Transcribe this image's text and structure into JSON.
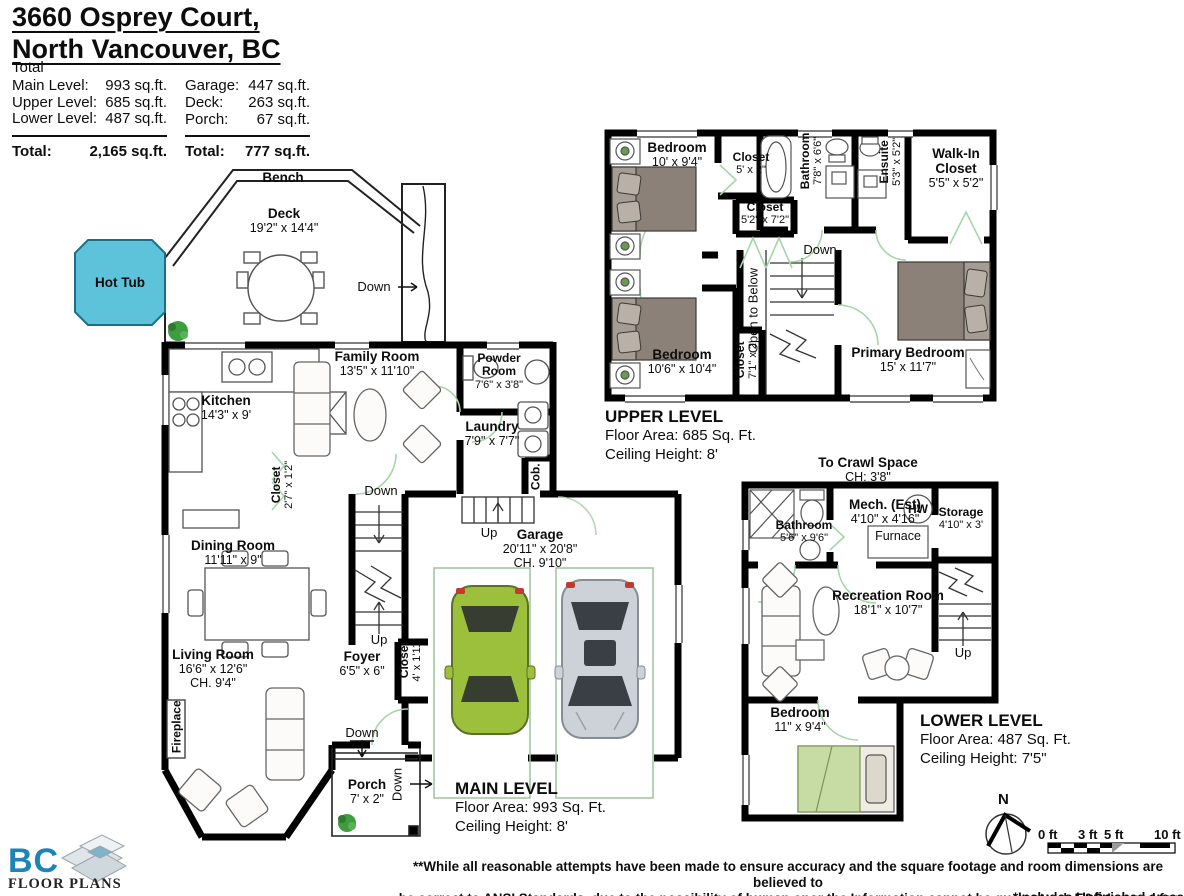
{
  "title": {
    "line1": "3660 Osprey Court,",
    "line2": "North Vancouver, BC"
  },
  "areas": {
    "header": "Total",
    "rows_left": [
      {
        "label": "Main Level:",
        "value": "993 sq.ft."
      },
      {
        "label": "Upper Level:",
        "value": "685 sq.ft."
      },
      {
        "label": "Lower Level:",
        "value": "487 sq.ft."
      }
    ],
    "total_left": {
      "label": "Total:",
      "value": "2,165 sq.ft."
    },
    "rows_right": [
      {
        "label": "Garage:",
        "value": "447 sq.ft."
      },
      {
        "label": "Deck:",
        "value": "263 sq.ft."
      },
      {
        "label": "Porch:",
        "value": "67 sq.ft."
      }
    ],
    "total_right": {
      "label": "Total:",
      "value": "777 sq.ft."
    }
  },
  "labels": {
    "down": "Down",
    "up": "Up",
    "bench": "Bench",
    "hot_tub": "Hot Tub",
    "open_to_below": "Open to Below",
    "north": "N"
  },
  "main_level": {
    "heading": "MAIN LEVEL",
    "floor_area": "Floor Area: 993 Sq. Ft.",
    "ceiling": "Ceiling Height: 8'",
    "rooms": {
      "deck": {
        "name": "Deck",
        "dims": "19'2\" x 14'4\""
      },
      "kitchen": {
        "name": "Kitchen",
        "dims": "14'3\" x 9'"
      },
      "family_room": {
        "name": "Family Room",
        "dims": "13'5\" x 11'10\""
      },
      "powder_room": {
        "name1": "Powder",
        "name2": "Room",
        "dims": "7'6\" x 3'8\""
      },
      "laundry": {
        "name": "Laundry",
        "dims": "7'9\" x 7'7\""
      },
      "cab": "Cob.",
      "closet_hall": {
        "name": "Closet",
        "dims": "2'7\" x 1'2\""
      },
      "dining_room": {
        "name": "Dining Room",
        "dims": "11'11\" x 9\""
      },
      "living_room": {
        "name": "Living Room",
        "dims": "16'6\" x 12'6\"",
        "ch": "CH. 9'4\""
      },
      "fireplace": "Fireplace",
      "foyer": {
        "name": "Foyer",
        "dims": "6'5\" x 6\""
      },
      "closet_foyer": {
        "name": "Closet",
        "dims": "4' x 1'11\""
      },
      "garage": {
        "name": "Garage",
        "dims": "20'11\" x 20'8\"",
        "ch": "CH. 9'10\""
      },
      "porch": {
        "name": "Porch",
        "dims": "7' x 2\""
      }
    }
  },
  "upper_level": {
    "heading": "UPPER LEVEL",
    "floor_area": "Floor Area: 685 Sq. Ft.",
    "ceiling": "Ceiling Height: 8'",
    "rooms": {
      "bedroom1": {
        "name": "Bedroom",
        "dims": "10' x 9'4\""
      },
      "closet1": {
        "name": "Closet",
        "dims": "5' x 2\""
      },
      "bathroom": {
        "name": "Bathroom",
        "dims": "7'8\" x 6'6\""
      },
      "ensuite": {
        "name": "Ensuite",
        "dims": "5'3\" x 5'2\""
      },
      "walk_in_closet": {
        "name1": "Walk-In",
        "name2": "Closet",
        "dims": "5'5\" x 5'2\""
      },
      "closet2": {
        "name": "Closet",
        "dims": "5'2\" x 7'2\""
      },
      "closet3": {
        "name": "Closet",
        "dims": "7'1\" x 2'"
      },
      "bedroom2": {
        "name": "Bedroom",
        "dims": "10'6\" x 10'4\""
      },
      "primary": {
        "name": "Primary Bedroom",
        "dims": "15' x 11'7\""
      }
    }
  },
  "lower_level": {
    "heading": "LOWER LEVEL",
    "floor_area": "Floor Area: 487 Sq. Ft.",
    "ceiling": "Ceiling Height: 7'5\"",
    "crawl": {
      "name": "To Crawl Space",
      "dims": "CH: 3'8\""
    },
    "rooms": {
      "bathroom": {
        "name": "Bathroom",
        "dims": "5'6\" x 9'6\""
      },
      "mech": {
        "name": "Mech. (Est)",
        "dims": "4'10\" x 4'16\""
      },
      "hw": "HW",
      "furnace": "Furnace",
      "storage": {
        "name": "Storage",
        "dims": "4'10\" x 3'"
      },
      "recreation": {
        "name": "Recreation Room",
        "dims": "18'1\" x 10'7\""
      },
      "bedroom": {
        "name": "Bedroom",
        "dims": "11\" x 9'4\""
      }
    }
  },
  "scale": {
    "labels": [
      "0 ft",
      "3 ft",
      "5 ft",
      "10 ft"
    ]
  },
  "logo": {
    "bc": "BC",
    "floor_plans": "FLOOR PLANS"
  },
  "footer": {
    "line1": "**While all reasonable attempts have been made to ensure accuracy and the square footage and room dimensions are believed to",
    "line2": "be correct to ANSI Standards, due to the possibility of human onor the Information cannot be guaranteed. E&O Insured for $1,000,000",
    "line3": "*Includes Unfinished areas"
  },
  "colors": {
    "hot_tub": "#5cc3da",
    "door_green": "#a5d6a5",
    "car_green": "#9dc03c",
    "car_silver": "#ccd2d8",
    "bed_gray": "#8b8179",
    "bed_green_lower": "#c7dba4",
    "logo_blue": "#1d84b5"
  }
}
